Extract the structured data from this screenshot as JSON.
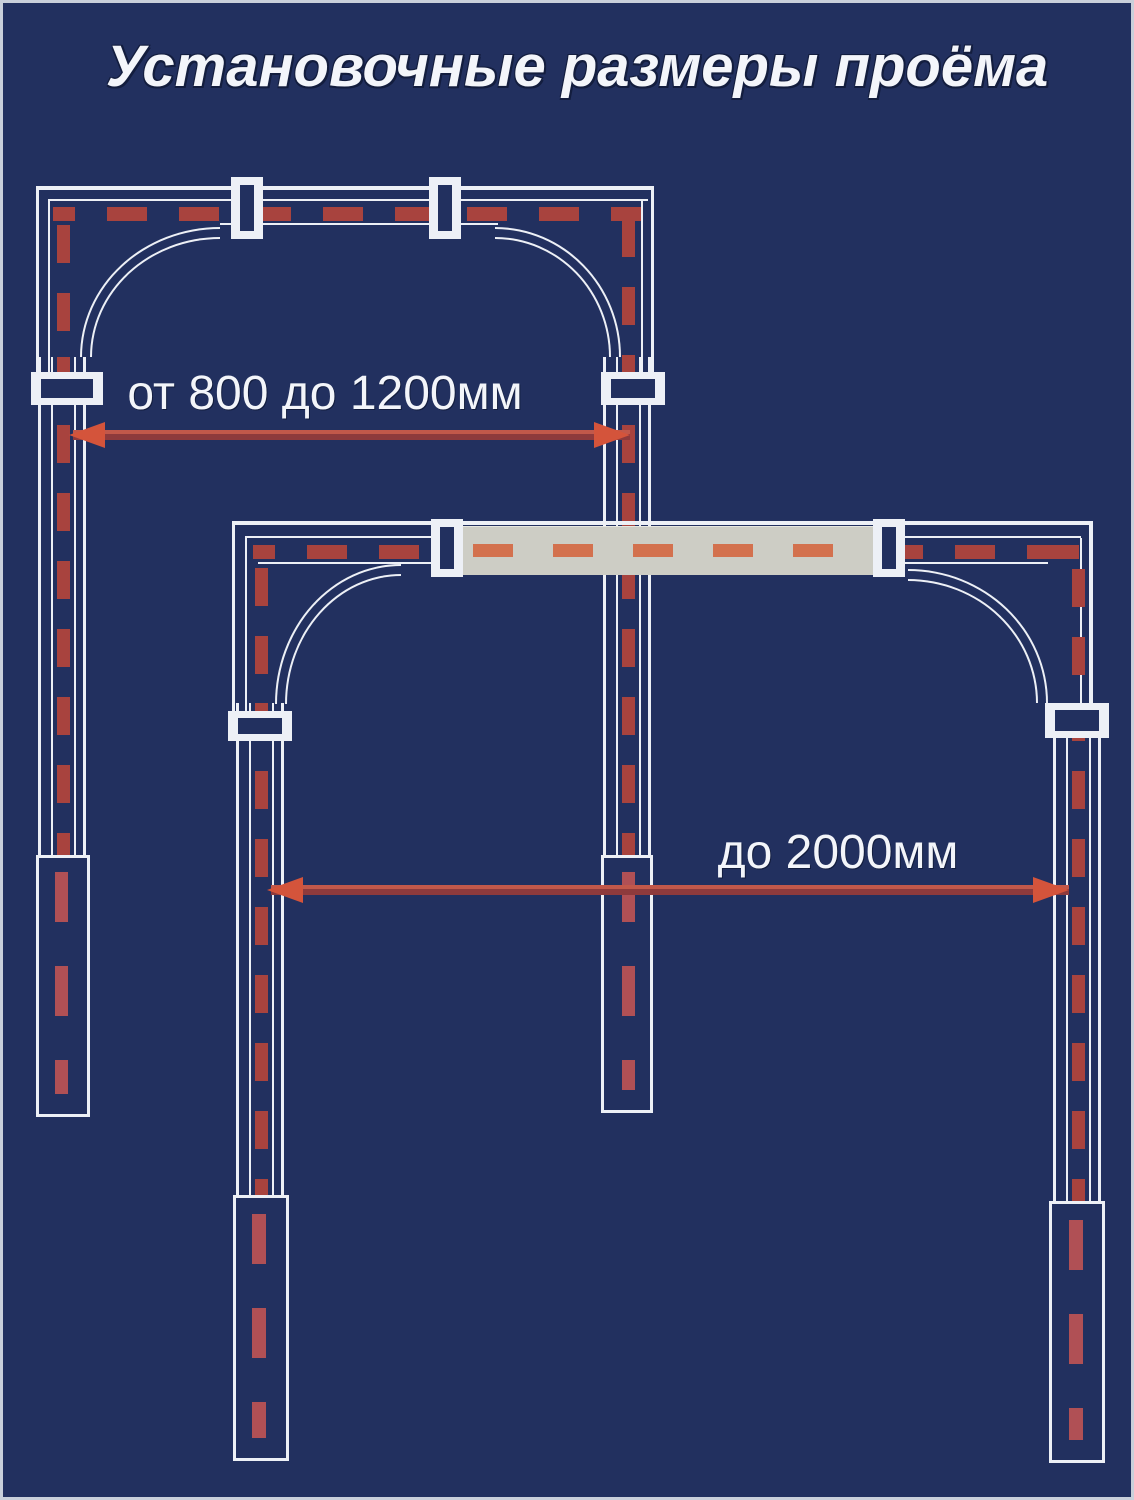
{
  "title": "Установочные размеры проёма",
  "diagram": {
    "arch_small": {
      "dimension_label": "от 800 до 1200мм"
    },
    "arch_large": {
      "dimension_label": "до 2000мм"
    }
  },
  "colors": {
    "bg": "#22305f",
    "line": "#edf0f6",
    "dash": "#a8433e",
    "dash_bright": "#d3714e",
    "dash_foot": "#b05055",
    "bar": "#cdcdc5",
    "arrow_line": "#8e3a3c",
    "arrow_head": "#d4543b",
    "text": "#f3f5fa"
  }
}
